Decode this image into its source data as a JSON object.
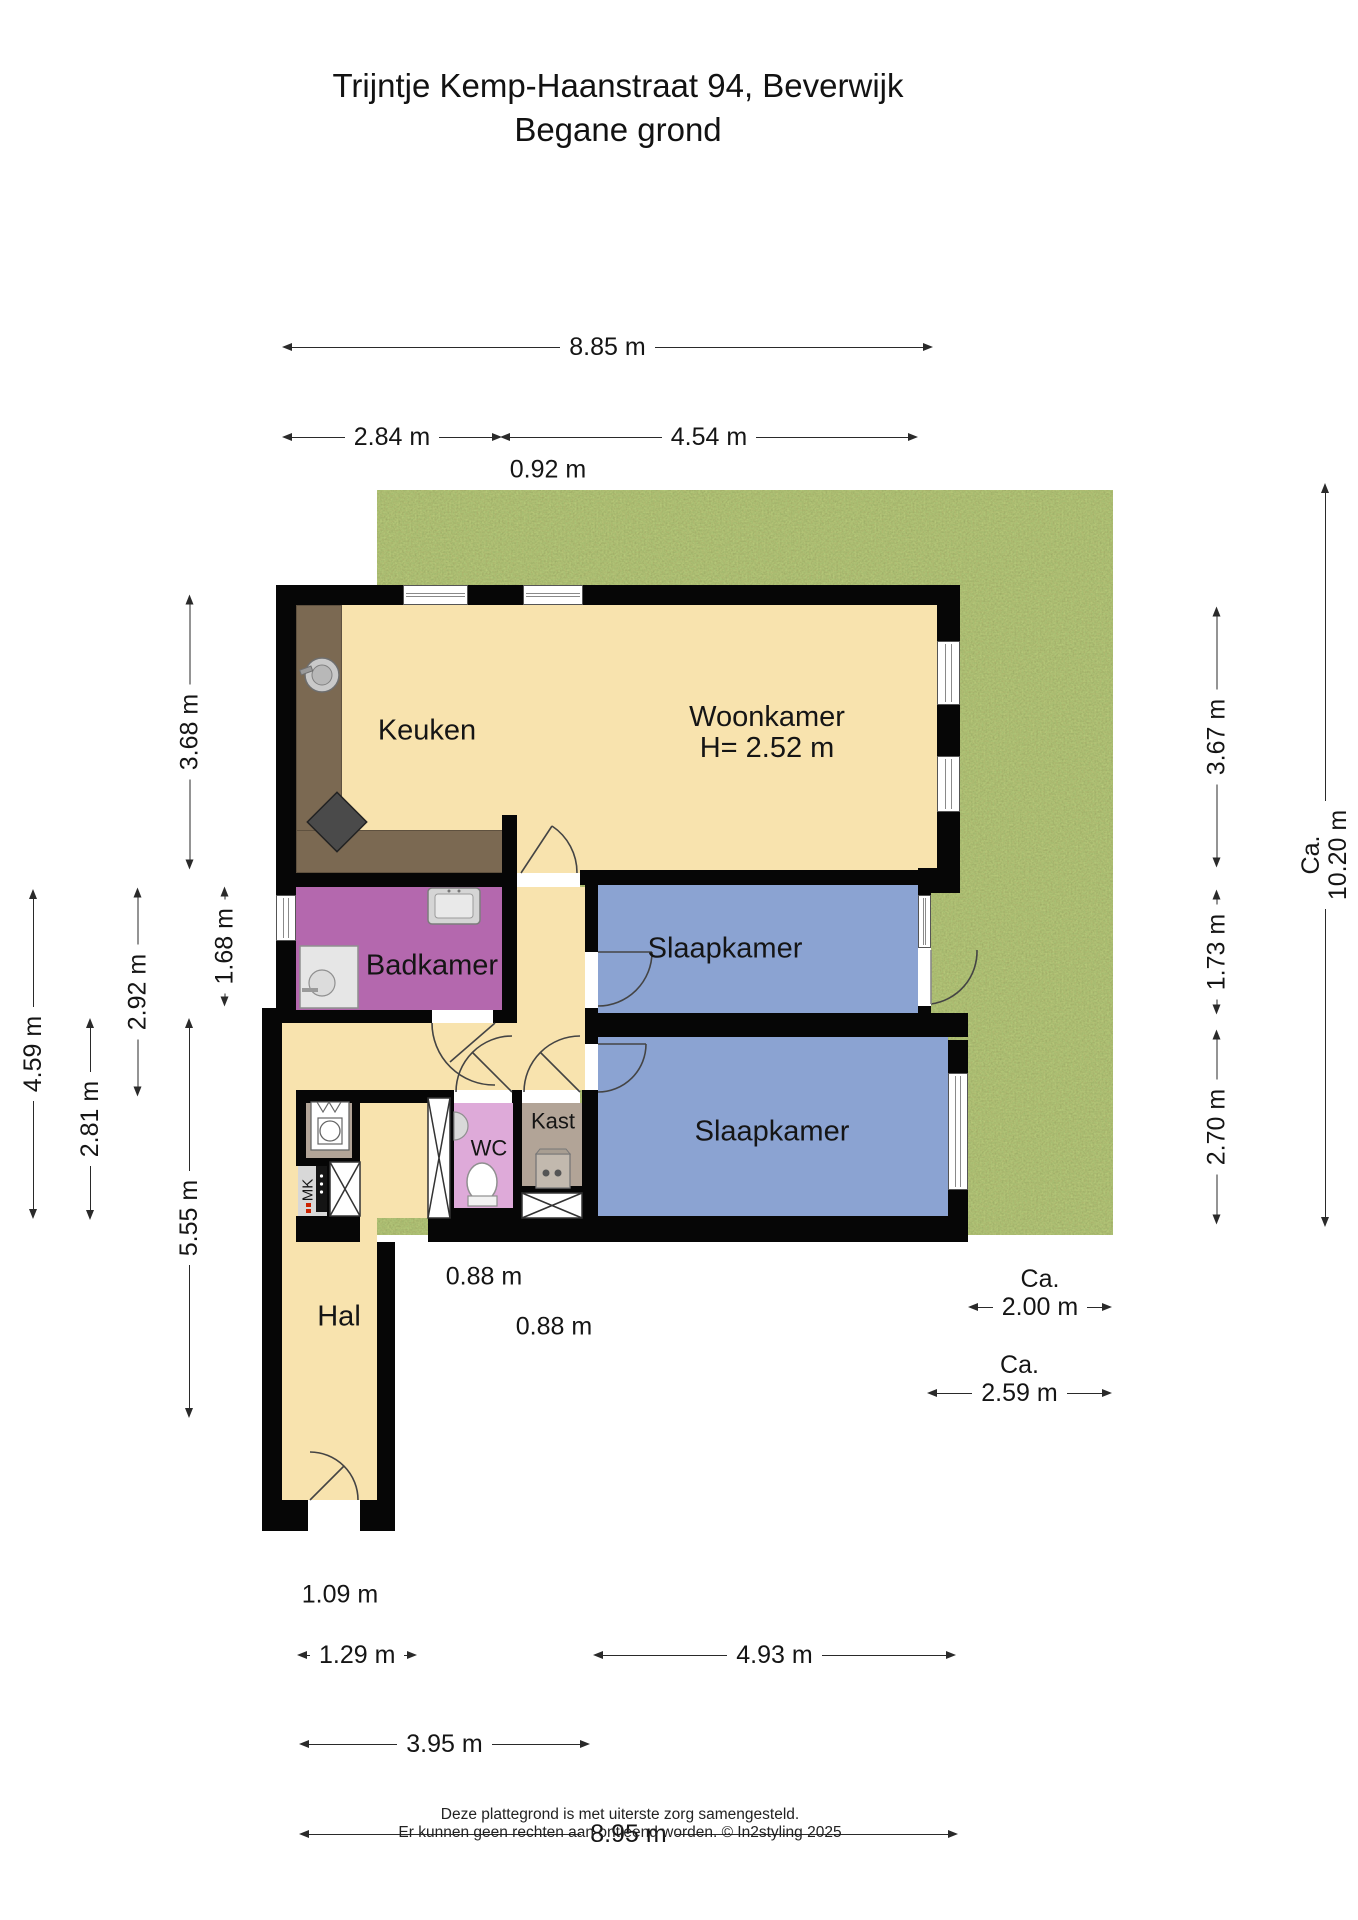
{
  "title": {
    "line1": "Trijntje Kemp-Haanstraat 94, Beverwijk",
    "line2": "Begane grond"
  },
  "rooms": {
    "keuken": "Keuken",
    "woonkamer": "Woonkamer",
    "woonkamer_height": "H= 2.52 m",
    "badkamer": "Badkamer",
    "slaapkamer1": "Slaapkamer",
    "slaapkamer2": "Slaapkamer",
    "wc": "WC",
    "kast": "Kast",
    "hal": "Hal",
    "mk": "MK"
  },
  "dims": {
    "ca": "Ca.",
    "d885": "8.85 m",
    "d284": "2.84 m",
    "d454": "4.54 m",
    "d092": "0.92 m",
    "d368": "3.68 m",
    "d168": "1.68 m",
    "d292": "2.92 m",
    "d459": "4.59 m",
    "d281": "2.81 m",
    "d555": "5.55 m",
    "d367": "3.67 m",
    "d173": "1.73 m",
    "d270": "2.70 m",
    "d1020": "10.20 m",
    "d200": "2.00 m",
    "d259": "2.59 m",
    "d088a": "0.88 m",
    "d088b": "0.88 m",
    "d109": "1.09 m",
    "d129": "1.29 m",
    "d493": "4.93 m",
    "d395": "3.95 m",
    "d895": "8.95 m"
  },
  "footer": {
    "line1": "Deze plattegrond is met uiterste zorg samengesteld.",
    "line2": "Er kunnen geen rechten aan ontleend worden. © In2styling 2025"
  },
  "colors": {
    "wall": "#060606",
    "floor": "#f8e3ae",
    "bedroom": "#8ba3d2",
    "bathroom": "#b468ae",
    "wc": "#deaad9",
    "closet": "#b2a497",
    "counter": "#7b6952",
    "grass": "#76853d",
    "dimension_lines": "#2a2a2a"
  }
}
